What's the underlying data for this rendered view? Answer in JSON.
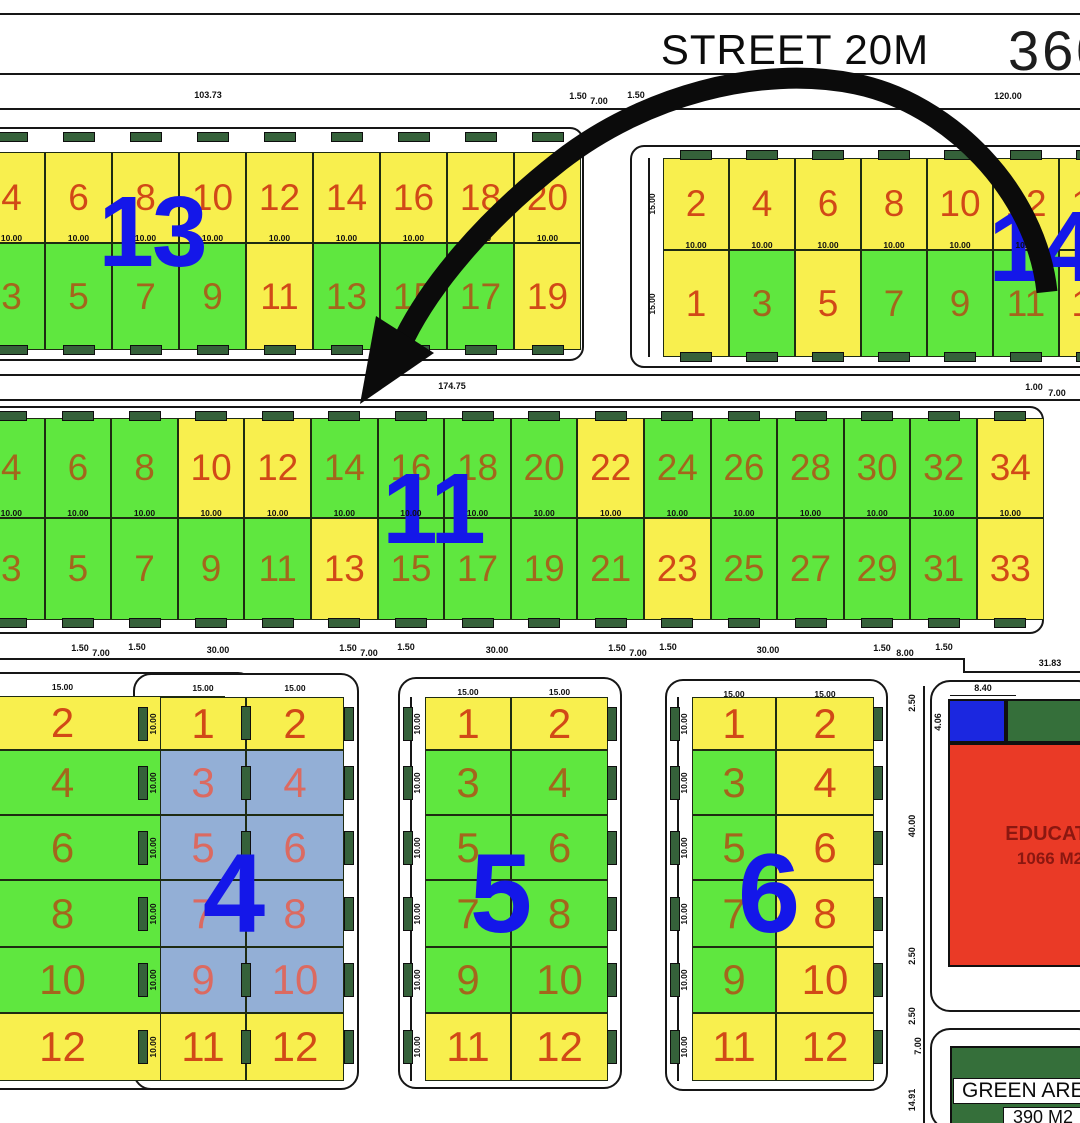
{
  "street": {
    "name": "STREET 20M",
    "corner_number": "360"
  },
  "education": {
    "width_dim": "8.40",
    "height_dim": "4.06",
    "label": "EDUCATION",
    "area": "1066 M2"
  },
  "green_area": {
    "label": "GREEN AREA",
    "area": "390 M2"
  },
  "colors": {
    "yellow": "#f8ef4e",
    "green": "#5fe73f",
    "blue": "#93afd6",
    "plot_num_yellow": "#d14917",
    "plot_num_green": "#a3661c",
    "plot_num_blue": "#db6a61",
    "block_num": "#1417e9",
    "marker": "#35613a",
    "edu_red": "#ea3a26",
    "edu_blue": "#1b27e0",
    "dark_green": "#356f3a",
    "edu_text": "#8b1710"
  },
  "dims": [
    {
      "t": "103.73",
      "x": 208,
      "y": 95
    },
    {
      "t": "1.50",
      "x": 578,
      "y": 96
    },
    {
      "t": "7.00",
      "x": 599,
      "y": 101
    },
    {
      "t": "1.50",
      "x": 636,
      "y": 95
    },
    {
      "t": "120.00",
      "x": 1008,
      "y": 96
    },
    {
      "t": "174.75",
      "x": 452,
      "y": 386
    },
    {
      "t": "1.00",
      "x": 1034,
      "y": 387
    },
    {
      "t": "7.00",
      "x": 1057,
      "y": 393
    },
    {
      "t": "1.50",
      "x": 80,
      "y": 648
    },
    {
      "t": "7.00",
      "x": 101,
      "y": 653
    },
    {
      "t": "1.50",
      "x": 137,
      "y": 647
    },
    {
      "t": "30.00",
      "x": 218,
      "y": 650
    },
    {
      "t": "1.50",
      "x": 348,
      "y": 648
    },
    {
      "t": "7.00",
      "x": 369,
      "y": 653
    },
    {
      "t": "1.50",
      "x": 406,
      "y": 647
    },
    {
      "t": "30.00",
      "x": 497,
      "y": 650
    },
    {
      "t": "1.50",
      "x": 617,
      "y": 648
    },
    {
      "t": "7.00",
      "x": 638,
      "y": 653
    },
    {
      "t": "1.50",
      "x": 668,
      "y": 647
    },
    {
      "t": "30.00",
      "x": 768,
      "y": 650
    },
    {
      "t": "1.50",
      "x": 882,
      "y": 648
    },
    {
      "t": "8.00",
      "x": 905,
      "y": 653
    },
    {
      "t": "1.50",
      "x": 944,
      "y": 647
    },
    {
      "t": "31.83",
      "x": 1050,
      "y": 663
    },
    {
      "t": "2.50",
      "x": 912,
      "y": 703,
      "r": 1
    },
    {
      "t": "40.00",
      "x": 912,
      "y": 826,
      "r": 1
    },
    {
      "t": "2.50",
      "x": 912,
      "y": 956,
      "r": 1
    },
    {
      "t": "2.50",
      "x": 912,
      "y": 1016,
      "r": 1
    },
    {
      "t": "7.00",
      "x": 918,
      "y": 1046,
      "r": 1
    },
    {
      "t": "14.91",
      "x": 912,
      "y": 1100,
      "r": 1
    }
  ],
  "lines": [
    {
      "x": 0,
      "y": 13,
      "w": 1080,
      "h": 2
    },
    {
      "x": 0,
      "y": 73,
      "w": 1080,
      "h": 2
    },
    {
      "x": 0,
      "y": 108,
      "w": 1080,
      "h": 1.5
    },
    {
      "x": 0,
      "y": 374,
      "w": 1080,
      "h": 1.5
    },
    {
      "x": 0,
      "y": 399,
      "w": 1080,
      "h": 1.5
    },
    {
      "x": 0,
      "y": 658,
      "w": 965,
      "h": 1.5
    },
    {
      "x": 963,
      "y": 658,
      "w": 1.5,
      "h": 14
    },
    {
      "x": 963,
      "y": 671,
      "w": 117,
      "h": 1.5
    },
    {
      "x": 923,
      "y": 686,
      "w": 1.5,
      "h": 437
    }
  ],
  "h_blocks": [
    {
      "id": "block-13",
      "number": "13",
      "num": {
        "x": 152,
        "y": 240,
        "s": 100
      },
      "plot_font": 37,
      "frame": {
        "x": -36,
        "y": 127,
        "w": 620,
        "h": 234
      },
      "grid": {
        "x0": -22,
        "w": 67,
        "rows": [
          152,
          243,
          350
        ]
      },
      "mid_dim": "10.00",
      "strip": null,
      "top": [
        [
          "4",
          "y"
        ],
        [
          "6",
          "y"
        ],
        [
          "8",
          "y"
        ],
        [
          "10",
          "y"
        ],
        [
          "12",
          "y"
        ],
        [
          "14",
          "y"
        ],
        [
          "16",
          "y"
        ],
        [
          "18",
          "y"
        ],
        [
          "20",
          "y"
        ]
      ],
      "bottom": [
        [
          "3",
          "g"
        ],
        [
          "5",
          "g"
        ],
        [
          "7",
          "g"
        ],
        [
          "9",
          "g"
        ],
        [
          "11",
          "y"
        ],
        [
          "13",
          "g"
        ],
        [
          "15",
          "g"
        ],
        [
          "17",
          "g"
        ],
        [
          "19",
          "y"
        ]
      ]
    },
    {
      "id": "block-14",
      "number": "14",
      "num": {
        "x": 1042,
        "y": 255,
        "s": 100
      },
      "plot_font": 37,
      "frame": {
        "x": 630,
        "y": 145,
        "w": 470,
        "h": 223
      },
      "grid": {
        "x0": 663,
        "w": 66,
        "rows": [
          158,
          250,
          357
        ]
      },
      "mid_dim": "10.00",
      "strip": {
        "x": 648,
        "label": "15.00"
      },
      "top": [
        [
          "2",
          "y"
        ],
        [
          "4",
          "y"
        ],
        [
          "6",
          "y"
        ],
        [
          "8",
          "y"
        ],
        [
          "10",
          "y"
        ],
        [
          "12",
          "y"
        ],
        [
          "14",
          "y"
        ]
      ],
      "bottom": [
        [
          "1",
          "y"
        ],
        [
          "3",
          "g"
        ],
        [
          "5",
          "y"
        ],
        [
          "7",
          "g"
        ],
        [
          "9",
          "g"
        ],
        [
          "11",
          "g"
        ],
        [
          "13",
          "y"
        ]
      ]
    },
    {
      "id": "block-11",
      "number": "11",
      "num": {
        "x": 433,
        "y": 517,
        "s": 100
      },
      "plot_font": 37,
      "frame": {
        "x": -36,
        "y": 406,
        "w": 1080,
        "h": 228
      },
      "grid": {
        "x0": -22,
        "w": 66.6,
        "rows": [
          418,
          518,
          620
        ]
      },
      "mid_dim": "10.00",
      "strip": null,
      "top": [
        [
          "4",
          "g"
        ],
        [
          "6",
          "g"
        ],
        [
          "8",
          "g"
        ],
        [
          "10",
          "y"
        ],
        [
          "12",
          "y"
        ],
        [
          "14",
          "g"
        ],
        [
          "16",
          "g"
        ],
        [
          "18",
          "g"
        ],
        [
          "20",
          "g"
        ],
        [
          "22",
          "y"
        ],
        [
          "24",
          "g"
        ],
        [
          "26",
          "g"
        ],
        [
          "28",
          "g"
        ],
        [
          "30",
          "g"
        ],
        [
          "32",
          "g"
        ],
        [
          "34",
          "y"
        ]
      ],
      "bottom": [
        [
          "3",
          "g"
        ],
        [
          "5",
          "g"
        ],
        [
          "7",
          "g"
        ],
        [
          "9",
          "g"
        ],
        [
          "11",
          "g"
        ],
        [
          "13",
          "y"
        ],
        [
          "15",
          "g"
        ],
        [
          "17",
          "g"
        ],
        [
          "19",
          "g"
        ],
        [
          "21",
          "g"
        ],
        [
          "23",
          "y"
        ],
        [
          "25",
          "g"
        ],
        [
          "27",
          "g"
        ],
        [
          "29",
          "g"
        ],
        [
          "31",
          "g"
        ],
        [
          "33",
          "y"
        ]
      ]
    }
  ],
  "v_blocks": [
    {
      "id": "block-left-partial",
      "number": null,
      "num": null,
      "plot_font": 42,
      "frame": {
        "x": -110,
        "y": 672,
        "w": 366,
        "h": 418
      },
      "cols": [
        -100,
        225
      ],
      "rows_y": [
        696,
        750,
        815,
        880,
        947,
        1013,
        1081
      ],
      "col_label": "15.00",
      "strip_label": null,
      "strip_x": null,
      "marker_sides": [
        "right"
      ],
      "rows": [
        [
          [
            "2",
            "y"
          ]
        ],
        [
          [
            "4",
            "g"
          ]
        ],
        [
          [
            "6",
            "g"
          ]
        ],
        [
          [
            "8",
            "g"
          ]
        ],
        [
          [
            "10",
            "g"
          ]
        ],
        [
          [
            "12",
            "y"
          ]
        ]
      ]
    },
    {
      "id": "block-4",
      "number": "4",
      "num": {
        "x": 233,
        "y": 903,
        "s": 112
      },
      "plot_font": 42,
      "frame": {
        "x": 133,
        "y": 673,
        "w": 226,
        "h": 417
      },
      "cols": [
        160,
        246,
        344
      ],
      "rows_y": [
        697,
        750,
        815,
        880,
        947,
        1013,
        1081
      ],
      "col_label": "15.00",
      "strip_label": "10.00",
      "strip_x": 149,
      "marker_sides": [
        "left",
        "right"
      ],
      "rows": [
        [
          [
            "1",
            "y"
          ],
          [
            "2",
            "y"
          ]
        ],
        [
          [
            "3",
            "b"
          ],
          [
            "4",
            "b"
          ]
        ],
        [
          [
            "5",
            "b"
          ],
          [
            "6",
            "b"
          ]
        ],
        [
          [
            "7",
            "b"
          ],
          [
            "8",
            "b"
          ]
        ],
        [
          [
            "9",
            "b"
          ],
          [
            "10",
            "b"
          ]
        ],
        [
          [
            "11",
            "y"
          ],
          [
            "12",
            "y"
          ]
        ]
      ]
    },
    {
      "id": "block-5",
      "number": "5",
      "num": {
        "x": 500,
        "y": 903,
        "s": 112
      },
      "plot_font": 42,
      "frame": {
        "x": 398,
        "y": 677,
        "w": 224,
        "h": 412
      },
      "cols": [
        425,
        511,
        608
      ],
      "rows_y": [
        697,
        750,
        815,
        880,
        947,
        1013,
        1081
      ],
      "col_label": "15.00",
      "strip_label": "10.00",
      "strip_x": 413,
      "marker_sides": [
        "left",
        "right"
      ],
      "rows": [
        [
          [
            "1",
            "y"
          ],
          [
            "2",
            "y"
          ]
        ],
        [
          [
            "3",
            "g"
          ],
          [
            "4",
            "g"
          ]
        ],
        [
          [
            "5",
            "g"
          ],
          [
            "6",
            "g"
          ]
        ],
        [
          [
            "7",
            "g"
          ],
          [
            "8",
            "g"
          ]
        ],
        [
          [
            "9",
            "g"
          ],
          [
            "10",
            "g"
          ]
        ],
        [
          [
            "11",
            "y"
          ],
          [
            "12",
            "y"
          ]
        ]
      ]
    },
    {
      "id": "block-6",
      "number": "6",
      "num": {
        "x": 768,
        "y": 903,
        "s": 112
      },
      "plot_font": 42,
      "frame": {
        "x": 665,
        "y": 679,
        "w": 223,
        "h": 412
      },
      "cols": [
        692,
        776,
        874
      ],
      "rows_y": [
        697,
        750,
        815,
        880,
        947,
        1013,
        1081
      ],
      "col_label": "15.00",
      "strip_label": "10.00",
      "strip_x": 680,
      "marker_sides": [
        "left",
        "right"
      ],
      "rows": [
        [
          [
            "1",
            "y"
          ],
          [
            "2",
            "y"
          ]
        ],
        [
          [
            "3",
            "g"
          ],
          [
            "4",
            "y"
          ]
        ],
        [
          [
            "5",
            "g"
          ],
          [
            "6",
            "y"
          ]
        ],
        [
          [
            "7",
            "g"
          ],
          [
            "8",
            "y"
          ]
        ],
        [
          [
            "9",
            "g"
          ],
          [
            "10",
            "y"
          ]
        ],
        [
          [
            "11",
            "y"
          ],
          [
            "12",
            "y"
          ]
        ]
      ]
    }
  ]
}
